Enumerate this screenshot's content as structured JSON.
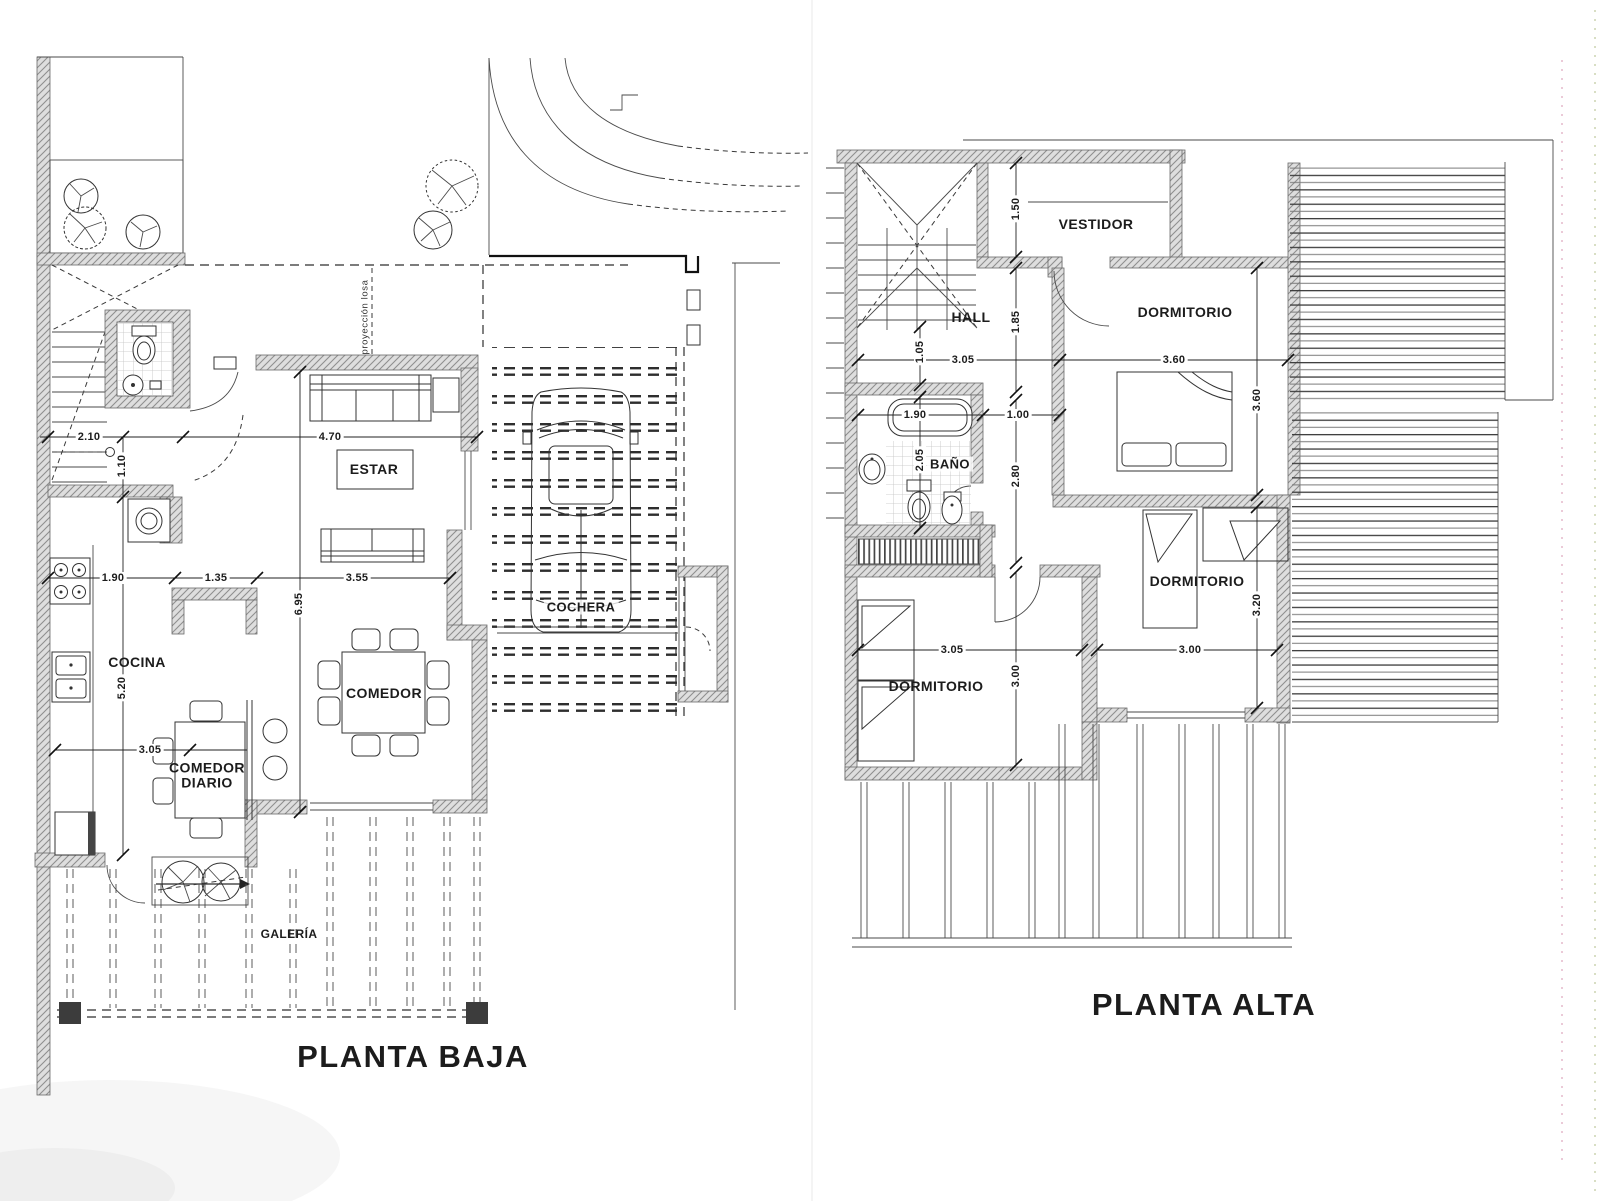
{
  "page": {
    "background": "#ffffff",
    "ink": "#1c1c1c"
  },
  "plans": {
    "baja": {
      "title": "PLANTA BAJA",
      "annotation": "proyección losa",
      "rooms": [
        "ESTAR",
        "COCINA",
        "COMEDOR",
        "COMEDOR DIARIO",
        "COCHERA",
        "GALERÍA"
      ],
      "dims": [
        "2.10",
        "4.70",
        "1.10",
        "1.90",
        "1.35",
        "3.55",
        "6.95",
        "5.20",
        "3.05"
      ]
    },
    "alta": {
      "title": "PLANTA ALTA",
      "rooms": [
        "VESTIDOR",
        "HALL",
        "DORMITORIO",
        "BAÑO",
        "DORMITORIO",
        "DORMITORIO"
      ],
      "dims": [
        "1.50",
        "1.85",
        "1.05",
        "3.05",
        "3.60",
        "1.90",
        "1.00",
        "2.05",
        "2.80",
        "3.60",
        "3.20",
        "3.05",
        "3.00",
        "3.00"
      ]
    }
  }
}
